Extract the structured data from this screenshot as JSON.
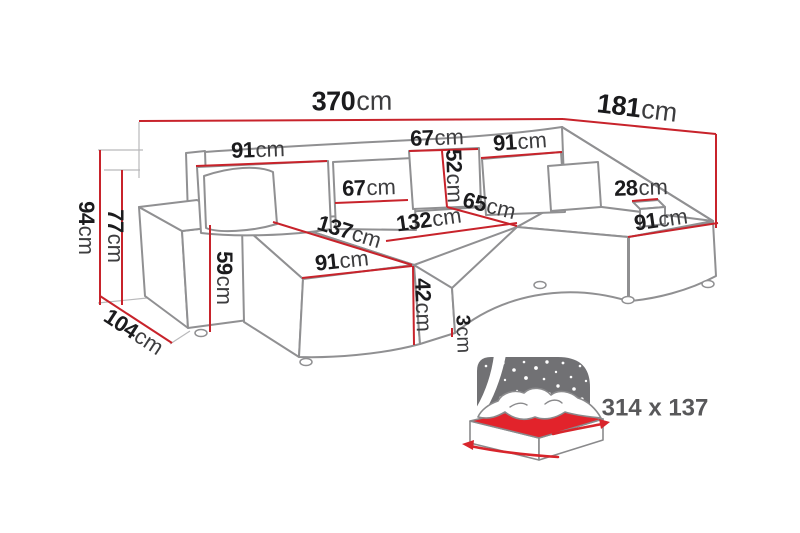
{
  "diagram_title": "u-shaped-sofa-dimension-diagram",
  "accent_color": "#c8232b",
  "outline_color": "#909092",
  "dims": [
    {
      "id": "total-width",
      "value": "370",
      "unit": "cm"
    },
    {
      "id": "total-depth",
      "value": "181",
      "unit": "cm"
    },
    {
      "id": "left-backrest-width",
      "value": "91",
      "unit": "cm"
    },
    {
      "id": "top-back-cushion-width",
      "value": "67",
      "unit": "cm"
    },
    {
      "id": "right-backrest-width",
      "value": "91",
      "unit": "cm"
    },
    {
      "id": "back-cushion-height",
      "value": "52",
      "unit": "cm"
    },
    {
      "id": "mid-back-cushion-width",
      "value": "67",
      "unit": "cm"
    },
    {
      "id": "right-armrest-width",
      "value": "28",
      "unit": "cm"
    },
    {
      "id": "seat-depth",
      "value": "65",
      "unit": "cm"
    },
    {
      "id": "middle-seat-width",
      "value": "132",
      "unit": "cm"
    },
    {
      "id": "chaise-length",
      "value": "137",
      "unit": "cm"
    },
    {
      "id": "right-chaise-width",
      "value": "91",
      "unit": "cm"
    },
    {
      "id": "left-chaise-width",
      "value": "91",
      "unit": "cm"
    },
    {
      "id": "seat-height",
      "value": "42",
      "unit": "cm"
    },
    {
      "id": "base-clearance",
      "value": "3",
      "unit": "cm"
    },
    {
      "id": "total-height",
      "value": "94",
      "unit": "cm"
    },
    {
      "id": "back-height",
      "value": "77",
      "unit": "cm"
    },
    {
      "id": "armrest-height",
      "value": "59",
      "unit": "cm"
    },
    {
      "id": "side-depth",
      "value": "104",
      "unit": "cm"
    }
  ],
  "bed_icon": {
    "label": "314 x 137"
  }
}
